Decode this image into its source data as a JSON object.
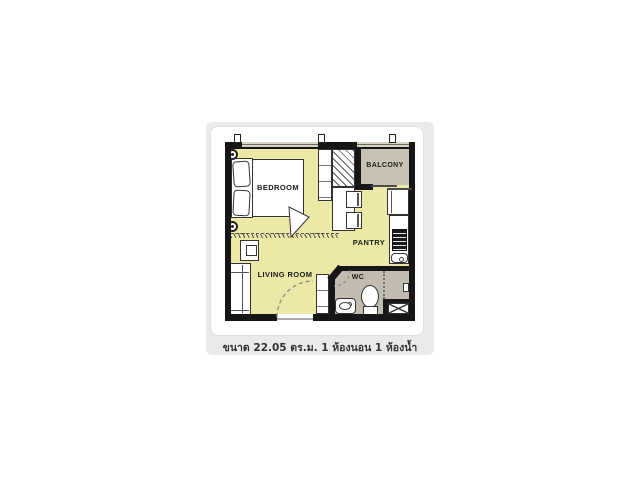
{
  "unit_floorplan": {
    "rooms": {
      "bedroom": "BEDROOM",
      "balcony": "BALCONY",
      "pantry": "PANTRY",
      "living_room": "LIVING ROOM",
      "wc": "WC"
    },
    "caption": "ขนาด 22.05 ตร.ม. 1 ห้องนอน 1 ห้องน้ำ",
    "unit_info": {
      "area_sqm": "22.05",
      "bedrooms": "1",
      "bathrooms": "1"
    },
    "colors": {
      "floor": "#ece8a6",
      "balcony_floor": "#c8c2b5",
      "wc_floor": "#c2bcb0",
      "wall": "#161616",
      "panel_bg": "#eaeaea",
      "card_bg": "#ffffff",
      "caption_text": "#333333"
    }
  }
}
